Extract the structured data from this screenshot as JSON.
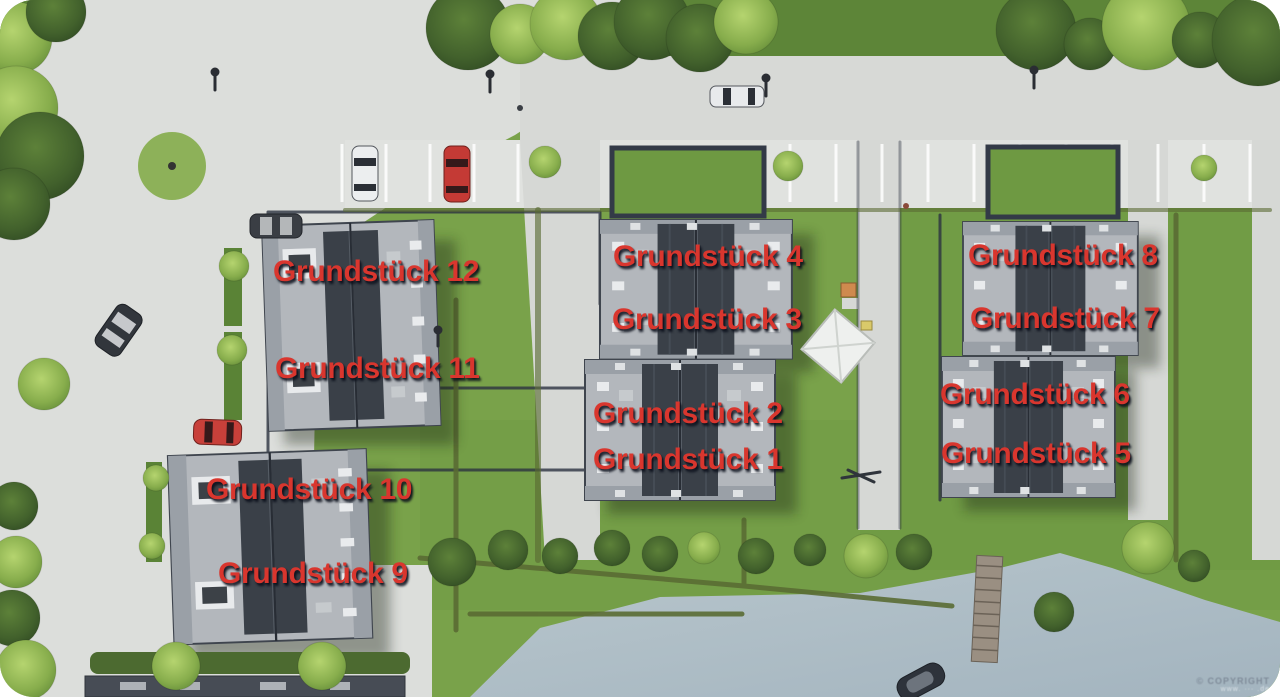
{
  "plan": {
    "description": "Aerial rendering of a housing development with twelve labeled plots, access roads, parking, lawns and a lake shore",
    "labels": [
      {
        "id": "grundstueck-12",
        "text": "Grundstück 12",
        "x": 273,
        "y": 257
      },
      {
        "id": "grundstueck-11",
        "text": "Grundstück 11",
        "x": 275,
        "y": 354
      },
      {
        "id": "grundstueck-10",
        "text": "Grundstück 10",
        "x": 206,
        "y": 475
      },
      {
        "id": "grundstueck-9",
        "text": "Grundstück 9",
        "x": 218,
        "y": 559
      },
      {
        "id": "grundstueck-4",
        "text": "Grundstück 4",
        "x": 613,
        "y": 242
      },
      {
        "id": "grundstueck-3",
        "text": "Grundstück 3",
        "x": 612,
        "y": 305
      },
      {
        "id": "grundstueck-2",
        "text": "Grundstück 2",
        "x": 593,
        "y": 399
      },
      {
        "id": "grundstueck-1",
        "text": "Grundstück 1",
        "x": 593,
        "y": 445
      },
      {
        "id": "grundstueck-8",
        "text": "Grundstück 8",
        "x": 968,
        "y": 241
      },
      {
        "id": "grundstueck-7",
        "text": "Grundstück 7",
        "x": 970,
        "y": 304
      },
      {
        "id": "grundstueck-6",
        "text": "Grundstück 6",
        "x": 940,
        "y": 380
      },
      {
        "id": "grundstueck-5",
        "text": "Grundstück 5",
        "x": 941,
        "y": 439
      }
    ],
    "watermark": {
      "line1": "© COPYRIGHT",
      "line2": "www. ··· .de"
    },
    "colors": {
      "label_red": "#d9362e",
      "grass": "#79a24a",
      "grass_dark": "#5d8538",
      "pavement": "#dcdedb",
      "water": "#aebec7",
      "roof_light": "#b3b7bc",
      "roof_solar_dark": "#3a4048",
      "boundary_navy": "#2c3240",
      "hedge_olive": "#5a6b33"
    }
  }
}
